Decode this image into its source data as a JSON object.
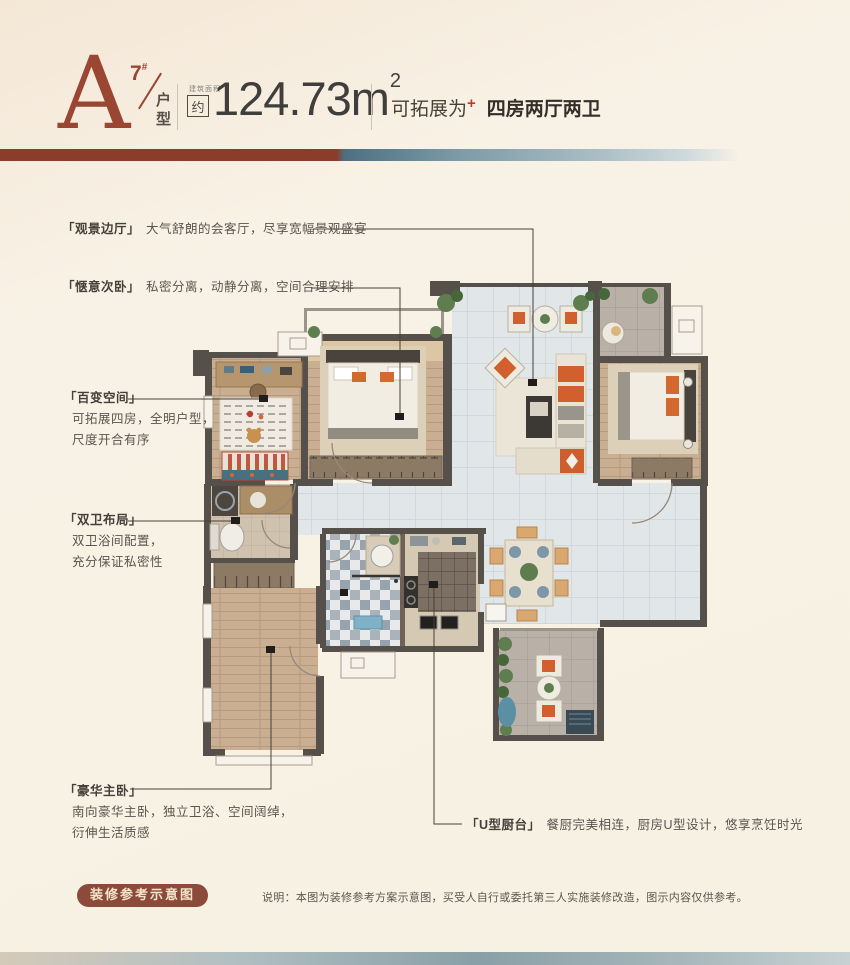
{
  "header": {
    "unit_letter": "A",
    "building_number": "7",
    "building_number_suffix": "#",
    "unit_type_label": "户型",
    "area_small_label": "建筑面积",
    "area_approx_label": "约",
    "area_value": "124.73m",
    "area_superscript": "2",
    "expand_label": "可拓展为",
    "expand_plus": "+",
    "expand_value": "四房两厅两卫"
  },
  "annotations": {
    "view_hall": {
      "title": "「观景边厅」",
      "desc": "大气舒朗的会客厅，尽享宽幅景观盛宴"
    },
    "cozy_bedroom": {
      "title": "「惬意次卧」",
      "desc": "私密分离，动静分离，空间合理安排"
    },
    "flex_space": {
      "title": "「百变空间」",
      "desc1": "可拓展四房，全明户型，",
      "desc2": "尺度开合有序"
    },
    "dual_bath": {
      "title": "「双卫布局」",
      "desc1": "双卫浴间配置，",
      "desc2": "充分保证私密性"
    },
    "master_bedroom": {
      "title": "「豪华主卧」",
      "desc1": "南向豪华主卧，独立卫浴、空间阔绰，",
      "desc2": "衍伸生活质感"
    },
    "u_kitchen": {
      "title": "「U型厨台」",
      "desc": "餐厨完美相连，厨房U型设计，悠享烹饪时光"
    }
  },
  "footer": {
    "badge": "装修参考示意图",
    "disclaimer": "说明：本图为装修参考方案示意图，买受人自行或委托第三人实施装修改造，图示内容仅供参考。"
  },
  "colors": {
    "accent_red": "#9a4632",
    "banner_brown": "#8a3d2b",
    "banner_blue": "#6d8b98",
    "badge_bg": "#8c4b3a",
    "wall": "#56504a"
  }
}
